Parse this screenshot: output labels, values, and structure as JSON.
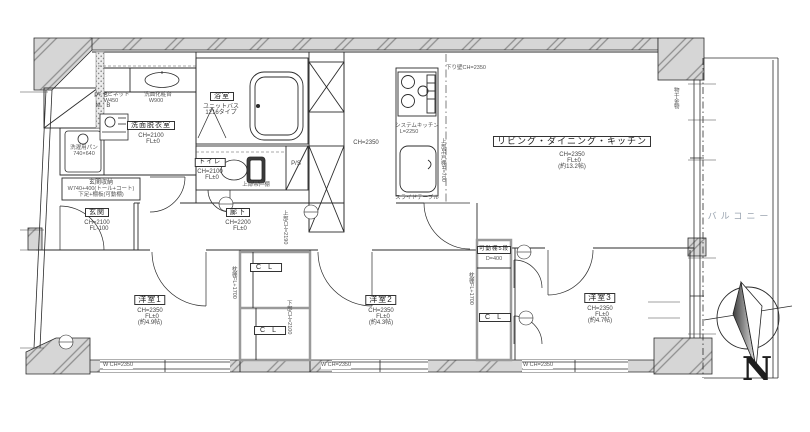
{
  "rooms": {
    "ldk": {
      "name": "リビング・ダイニング・キッチン",
      "ch": "CH=2350",
      "fl": "FL±0",
      "size": "(約13.2帖)"
    },
    "bed1": {
      "name": "洋室1",
      "ch": "CH=2350",
      "fl": "FL±0",
      "size": "(約4.9帖)"
    },
    "bed2": {
      "name": "洋室2",
      "ch": "CH=2350",
      "fl": "FL±0",
      "size": "(約4.3帖)"
    },
    "bed3": {
      "name": "洋室3",
      "ch": "CH=2350",
      "fl": "FL±0",
      "size": "(約4.7帖)"
    },
    "washroom": {
      "name": "洗面脱衣室",
      "ch": "CH=2100",
      "fl": "FL±0"
    },
    "bath": {
      "name": "浴室",
      "type": "ユニットバス",
      "model": "1216タイプ"
    },
    "toilet": {
      "name": "トイレ",
      "ch": "CH=2100",
      "fl": "FL±0",
      "upper": "上部吊戸棚"
    },
    "entry": {
      "name": "玄関",
      "ch": "CH=2100",
      "fl": "FL-100"
    },
    "hall": {
      "name": "廊下",
      "ch": "CH=2200",
      "fl": "FL±0",
      "upper": "上部CH=2190",
      "kitchen_ch": "CH=2350"
    },
    "balcony": {
      "name": "バルコニー",
      "laundry": "物干金物"
    }
  },
  "fixtures": {
    "ps": "P S",
    "mb": "M B",
    "ps2": "P/S",
    "washer_pan": "洗濯用パン",
    "washer_pan_size": "740×640",
    "cabinet": "キャビネット",
    "cabinet_w": "W450",
    "vanity": "洗面化粧台",
    "vanity_w": "W900",
    "entry_storage": "玄関収納",
    "entry_storage_spec": "W740+400(トール+コート)",
    "entry_storage_spec2": "下足+棚板(可動棚)",
    "kitchen": "システムキッチン",
    "kitchen_len": "L=2250",
    "kitchen_hood": "上部吊戸棚H=700",
    "slide_table": "スライドテーブル",
    "drop_wall": "下り壁CH=2350",
    "closet1": "CL",
    "closet2": "CL",
    "closet3": "CL",
    "shelf": "可動棚5段",
    "shelf_d": "D=400",
    "pillow_shelf": "枕棚FL+1700",
    "lower_ch": "下部CH=2100",
    "window1": "W CH=2350",
    "window2": "W CH=2350",
    "window3": "W CH=2350"
  },
  "compass": {
    "label": "N"
  }
}
